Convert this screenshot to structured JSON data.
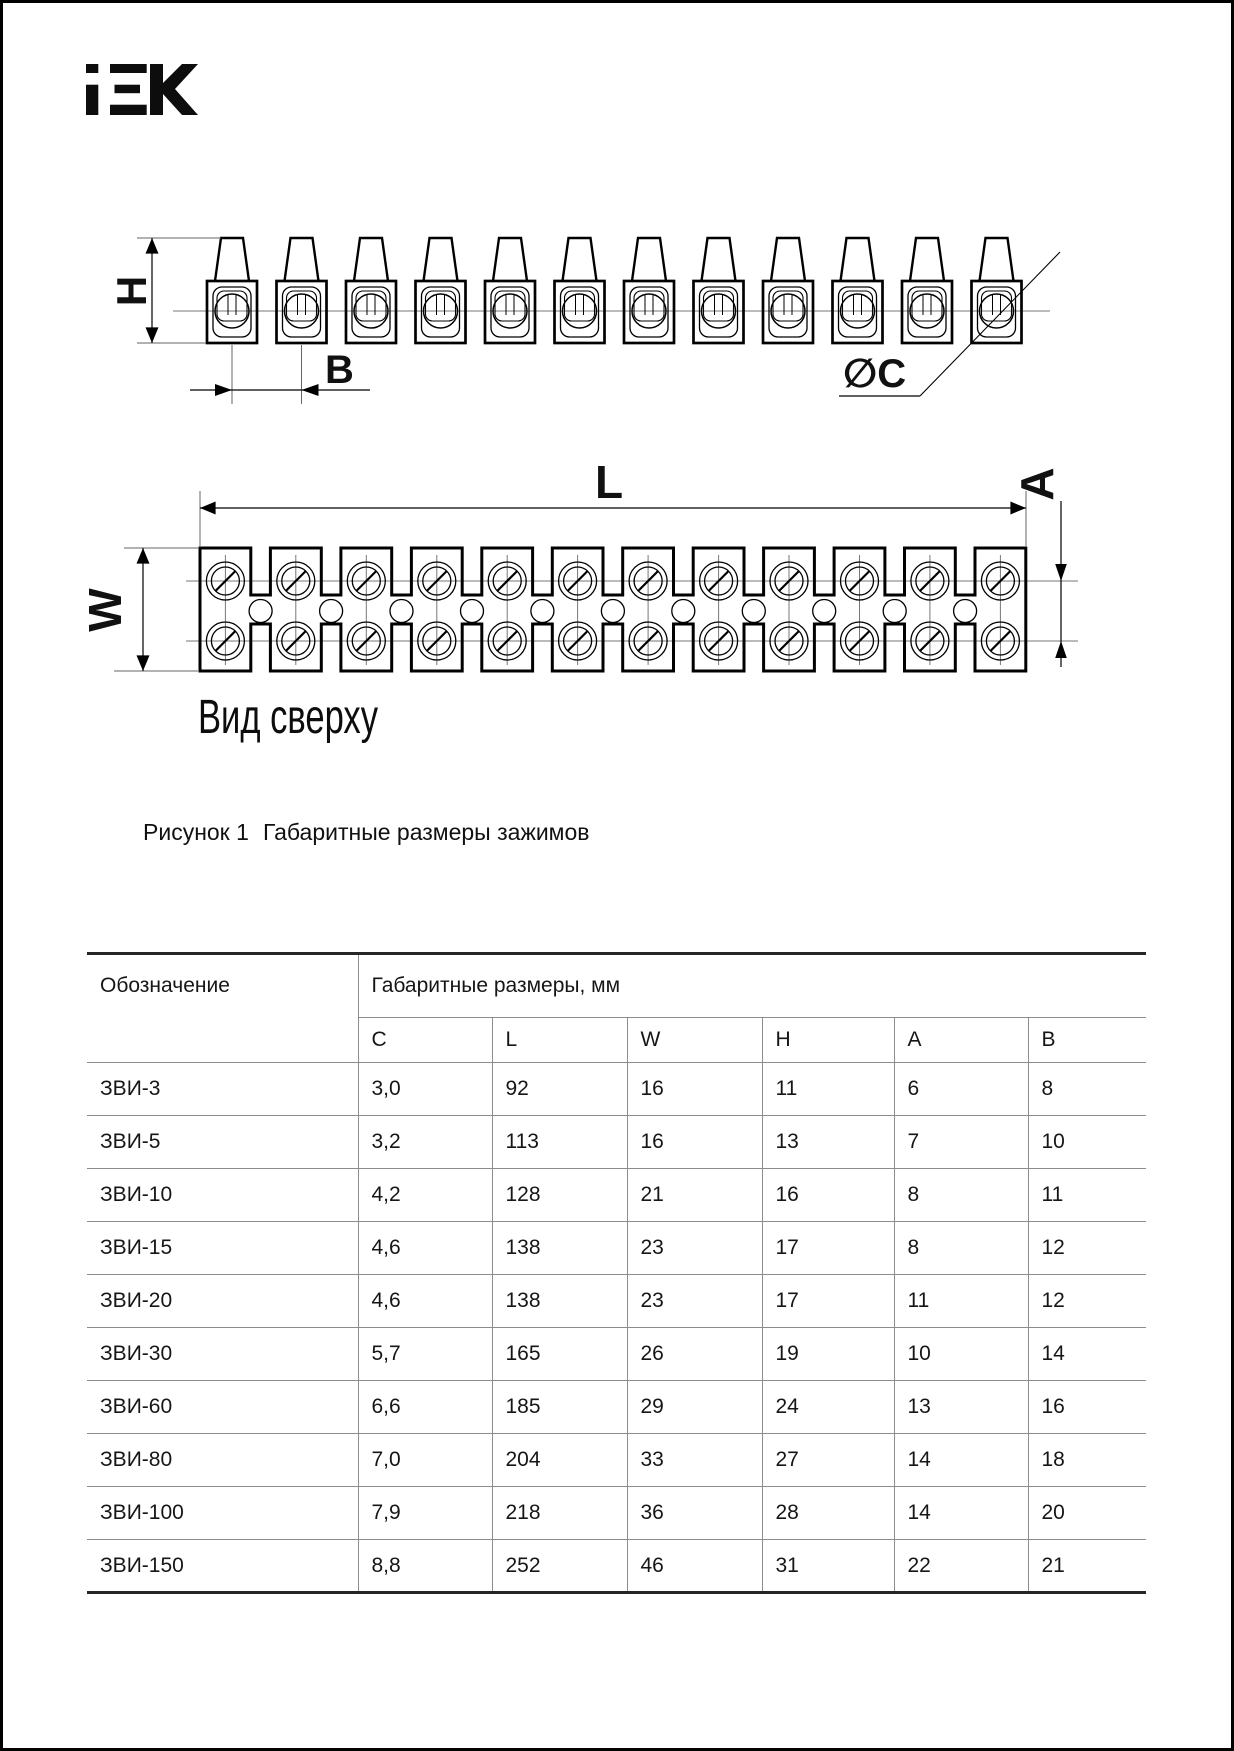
{
  "document": {
    "brand_logo": "IEK",
    "figure": {
      "sections": 12,
      "top_view_label": "Вид сверху",
      "caption_number": "Рисунок 1",
      "caption_text": "Габаритные размеры зажимов",
      "dimensions": {
        "height": "H",
        "pitch": "B",
        "hole_diameter": "∅C",
        "length": "L",
        "width": "W",
        "row_spacing": "A"
      }
    },
    "table": {
      "designation_header": "Обозначение",
      "dimensions_group_header": "Габаритные размеры, мм",
      "dimension_columns": [
        "C",
        "L",
        "W",
        "H",
        "A",
        "B"
      ],
      "rows": [
        {
          "designation": "ЗВИ-3",
          "values": [
            "3,0",
            "92",
            "16",
            "11",
            "6",
            "8"
          ]
        },
        {
          "designation": "ЗВИ-5",
          "values": [
            "3,2",
            "113",
            "16",
            "13",
            "7",
            "10"
          ]
        },
        {
          "designation": "ЗВИ-10",
          "values": [
            "4,2",
            "128",
            "21",
            "16",
            "8",
            "11"
          ]
        },
        {
          "designation": "ЗВИ-15",
          "values": [
            "4,6",
            "138",
            "23",
            "17",
            "8",
            "12"
          ]
        },
        {
          "designation": "ЗВИ-20",
          "values": [
            "4,6",
            "138",
            "23",
            "17",
            "11",
            "12"
          ]
        },
        {
          "designation": "ЗВИ-30",
          "values": [
            "5,7",
            "165",
            "26",
            "19",
            "10",
            "14"
          ]
        },
        {
          "designation": "ЗВИ-60",
          "values": [
            "6,6",
            "185",
            "29",
            "24",
            "13",
            "16"
          ]
        },
        {
          "designation": "ЗВИ-80",
          "values": [
            "7,0",
            "204",
            "33",
            "27",
            "14",
            "18"
          ]
        },
        {
          "designation": "ЗВИ-100",
          "values": [
            "7,9",
            "218",
            "36",
            "28",
            "14",
            "20"
          ]
        },
        {
          "designation": "ЗВИ-150",
          "values": [
            "8,8",
            "252",
            "46",
            "31",
            "22",
            "21"
          ]
        }
      ]
    },
    "colors": {
      "line": "#000000",
      "aux_line": "#777777",
      "text": "#111111"
    }
  }
}
